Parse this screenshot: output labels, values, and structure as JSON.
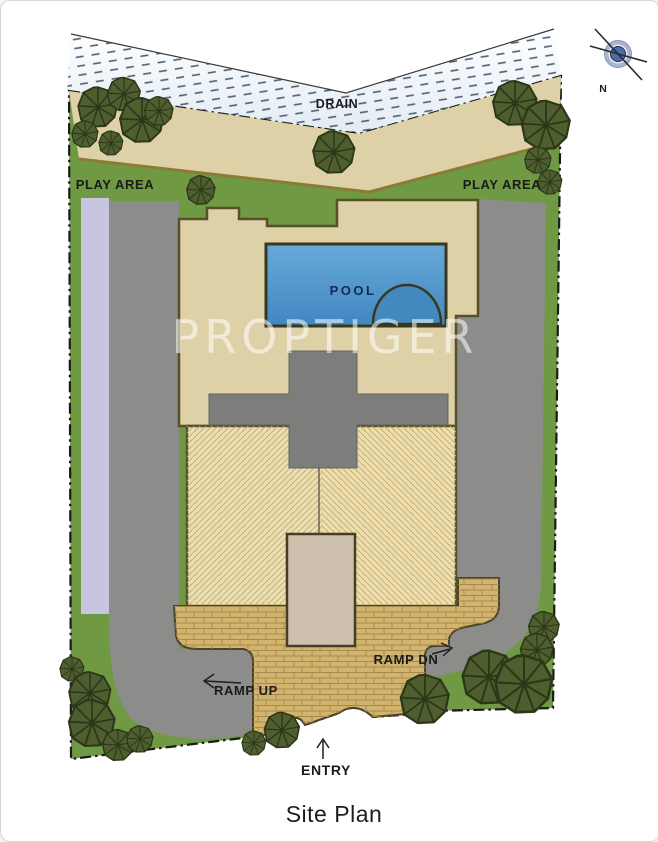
{
  "page": {
    "caption": "Site Plan"
  },
  "watermark": {
    "text": "PROPTIGER"
  },
  "compass": {
    "north_label": "N"
  },
  "labels": {
    "drain": "DRAIN",
    "play_area_left": "PLAY AREA",
    "play_area_right": "PLAY AREA",
    "pool": "POOL",
    "ramp_up": "RAMP UP",
    "ramp_down": "RAMP DN",
    "entry": "ENTRY"
  },
  "colors": {
    "lawn": "#6f9a43",
    "driveway": "#8c8c8a",
    "building": "#ded1a7",
    "building_hatched": "#ecdfb2",
    "courtyard": "#cdc1ae",
    "cross_block": "#7d7d7b",
    "pool": "#4e97cc",
    "pool_deep": "#4289c0",
    "paving": "#d3b46e",
    "walkway_strip": "#c7c5e0",
    "tree": "#4e5e2e",
    "site_line": "#8a7b36",
    "boundary": "#1a1a1a",
    "label_text": "#1a1a1a",
    "pool_text": "#16295a",
    "drain_hatch": "#4e5f72",
    "compass_ring": "#a9b4d3",
    "compass_core": "#4c6ba9"
  }
}
